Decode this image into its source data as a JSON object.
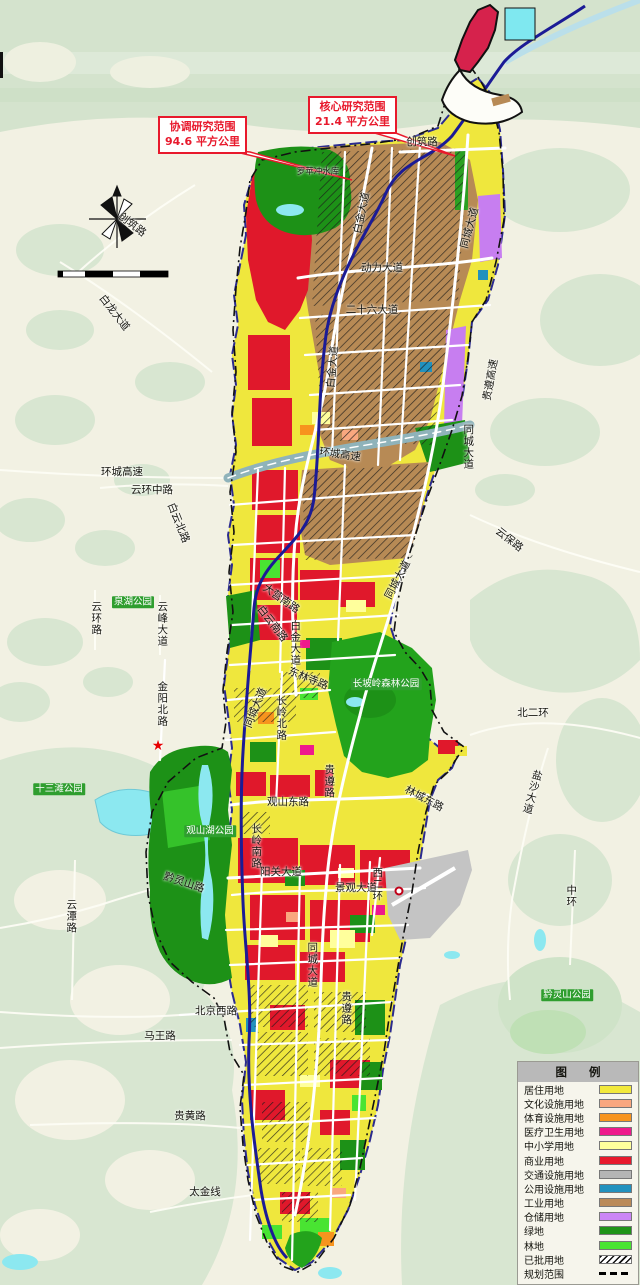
{
  "map": {
    "callouts": [
      {
        "line1": "协调研究范围",
        "line2": "94.6 平方公里"
      },
      {
        "line1": "核心研究范围",
        "line2": "21.4 平方公里"
      }
    ],
    "labels": [
      {
        "t": "创筑路",
        "x": 132,
        "y": 225,
        "r": 38
      },
      {
        "t": "创筑路",
        "x": 422,
        "y": 142
      },
      {
        "t": "白龙大道",
        "x": 114,
        "y": 313,
        "r": 52
      },
      {
        "t": "动力大道",
        "x": 382,
        "y": 268
      },
      {
        "t": "二十六大道",
        "x": 372,
        "y": 310
      },
      {
        "t": "白金大道",
        "x": 362,
        "y": 213,
        "r": -78
      },
      {
        "t": "同城大道",
        "x": 470,
        "y": 228,
        "r": -75
      },
      {
        "t": "白金大道",
        "x": 333,
        "y": 367,
        "r": -85
      },
      {
        "t": "同城大道",
        "x": 468,
        "y": 447,
        "v": 1
      },
      {
        "t": "贵遵高速",
        "x": 491,
        "y": 380,
        "r": -80
      },
      {
        "t": "环城高速",
        "x": 340,
        "y": 455,
        "r": 8
      },
      {
        "t": "环城高速",
        "x": 122,
        "y": 472
      },
      {
        "t": "云环中路",
        "x": 152,
        "y": 490
      },
      {
        "t": "白云北路",
        "x": 178,
        "y": 523,
        "r": 68
      },
      {
        "t": "云保路",
        "x": 509,
        "y": 540,
        "r": 38
      },
      {
        "t": "白金大道",
        "x": 295,
        "y": 643,
        "v": 1
      },
      {
        "t": "大营南路",
        "x": 281,
        "y": 599,
        "r": 35
      },
      {
        "t": "白云南路",
        "x": 272,
        "y": 624,
        "r": 52
      },
      {
        "t": "同城大道",
        "x": 398,
        "y": 580,
        "r": -62
      },
      {
        "t": "云峰大道",
        "x": 162,
        "y": 624,
        "v": 1
      },
      {
        "t": "云环路",
        "x": 96,
        "y": 618,
        "v": 1
      },
      {
        "t": "泉湖公园",
        "x": 133,
        "y": 602,
        "k": "badge"
      },
      {
        "t": "金阳北路",
        "x": 162,
        "y": 704,
        "v": 1
      },
      {
        "t": "东林寺路",
        "x": 308,
        "y": 679,
        "r": 22
      },
      {
        "t": "长岭北路",
        "x": 281,
        "y": 718,
        "v": 1
      },
      {
        "t": "同城大道",
        "x": 256,
        "y": 708,
        "r": -68
      },
      {
        "t": "长坡岭森林公园",
        "x": 386,
        "y": 684,
        "k": "badge"
      },
      {
        "t": "北二环",
        "x": 533,
        "y": 713
      },
      {
        "t": "云潭路",
        "x": 71,
        "y": 916,
        "v": 1
      },
      {
        "t": "十三滩公园",
        "x": 59,
        "y": 789,
        "k": "badge"
      },
      {
        "t": "观山湖公园",
        "x": 210,
        "y": 831,
        "k": "badge"
      },
      {
        "t": "观山东路",
        "x": 288,
        "y": 802
      },
      {
        "t": "贵遵路",
        "x": 329,
        "y": 781,
        "v": 1
      },
      {
        "t": "林城东路",
        "x": 424,
        "y": 799,
        "r": 28
      },
      {
        "t": "盐沙大道",
        "x": 532,
        "y": 792,
        "v": 1,
        "r": 15
      },
      {
        "t": "黔灵山路",
        "x": 184,
        "y": 883,
        "r": 18
      },
      {
        "t": "长岭南路",
        "x": 256,
        "y": 846,
        "v": 1
      },
      {
        "t": "阳关大道",
        "x": 281,
        "y": 872
      },
      {
        "t": "西二环",
        "x": 377,
        "y": 884,
        "v": 1
      },
      {
        "t": "景观大道",
        "x": 356,
        "y": 888
      },
      {
        "t": "同城大道",
        "x": 312,
        "y": 965,
        "v": 1
      },
      {
        "t": "贵遵路",
        "x": 346,
        "y": 1008,
        "v": 1
      },
      {
        "t": "中环",
        "x": 571,
        "y": 896,
        "v": 1
      },
      {
        "t": "北京西路",
        "x": 216,
        "y": 1011
      },
      {
        "t": "马王路",
        "x": 160,
        "y": 1036
      },
      {
        "t": "黔灵山公园",
        "x": 567,
        "y": 995,
        "k": "badge"
      },
      {
        "t": "贵黄路",
        "x": 190,
        "y": 1116
      },
      {
        "t": "太金线",
        "x": 205,
        "y": 1192
      },
      {
        "t": "罗苹冲水库",
        "x": 318,
        "y": 172,
        "k": "small"
      }
    ],
    "poi": {
      "city_hall": {
        "t": "市政府",
        "x": 167,
        "y": 731
      },
      "star": {
        "x": 158,
        "y": 746
      },
      "station": {
        "t": "贵阳火车北站",
        "x": 433,
        "y": 891
      },
      "station_icon": {
        "x": 399,
        "y": 891
      }
    },
    "scalebar": {
      "ticks": [
        {
          "t": "0",
          "x": 58
        },
        {
          "t": "100",
          "x": 66
        },
        {
          "t": "500",
          "x": 86
        },
        {
          "t": "1000",
          "x": 106
        },
        {
          "t": "2000 m",
          "x": 150
        }
      ]
    }
  },
  "legend": {
    "title": "图 例",
    "items": [
      {
        "label": "居住用地",
        "color": "#f2e93c"
      },
      {
        "label": "文化设施用地",
        "color": "#f9a77f"
      },
      {
        "label": "体育设施用地",
        "color": "#f7941e"
      },
      {
        "label": "医疗卫生用地",
        "color": "#ee1a8c"
      },
      {
        "label": "中小学用地",
        "color": "#ffff9c"
      },
      {
        "label": "商业用地",
        "color": "#e8192c"
      },
      {
        "label": "交通设施用地",
        "color": "#b5b5b5"
      },
      {
        "label": "公用设施用地",
        "color": "#2191be"
      },
      {
        "label": "工业用地",
        "color": "#ba8a58"
      },
      {
        "label": "仓储用地",
        "color": "#cb85f5"
      },
      {
        "label": "绿地",
        "color": "#1f9418"
      },
      {
        "label": "林地",
        "color": "#49e432"
      },
      {
        "label": "已批用地",
        "type": "hatch"
      },
      {
        "label": "规划范围",
        "type": "dash"
      }
    ]
  },
  "colors": {
    "terrain_bg": "#f2f1e3",
    "terrain_green": "#d8e6d1",
    "water": "#8ce8f0",
    "boundary_outer": "#111111",
    "boundary_core": "#1b1b96",
    "callout_accent": "#e8192c"
  }
}
